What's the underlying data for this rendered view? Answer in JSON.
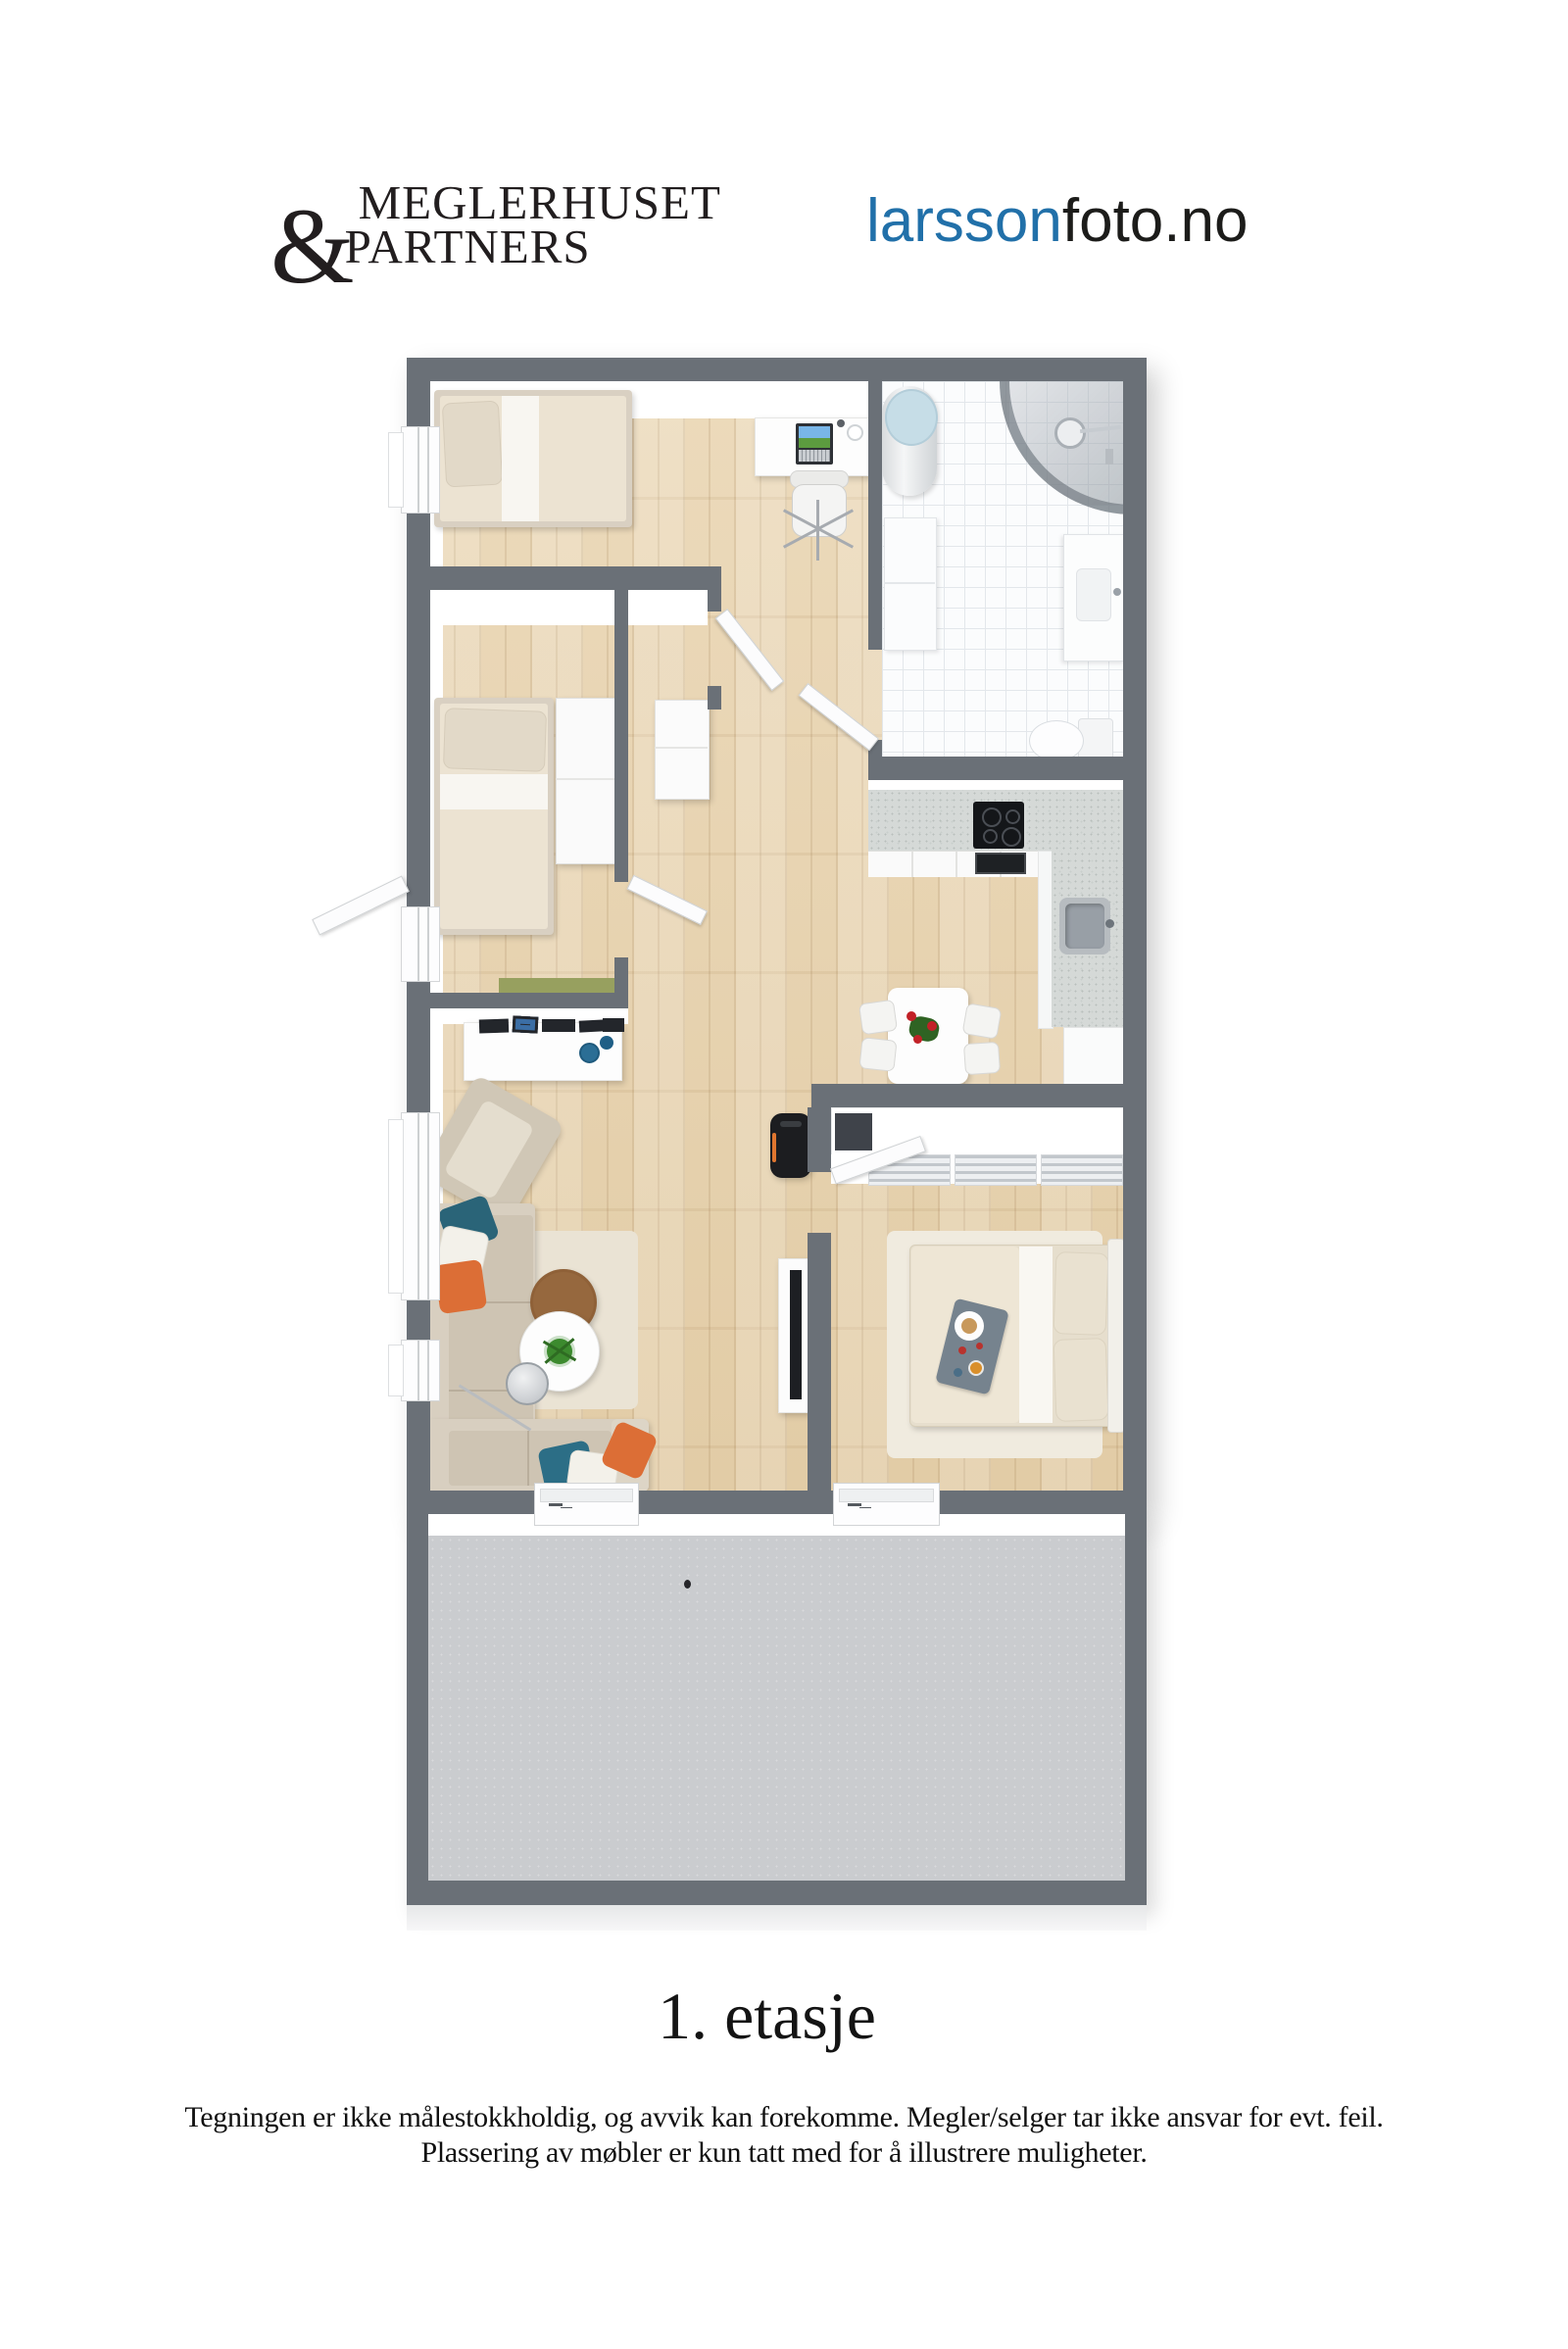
{
  "header": {
    "logo": {
      "ampersand": "&",
      "line1": "MEGLERHUSET",
      "line2": "PARTNERS",
      "color": "#221e1f"
    },
    "brand": {
      "name_part1": "larsson",
      "name_part2": "foto.no"
    }
  },
  "floorplan": {
    "floor_label": "1. etasje",
    "colors": {
      "wall": "#6a7077",
      "wood": "#e7d4b2",
      "tile": "#fbfcfd",
      "terrace": "#cacccf",
      "counter": "#d5d9d7",
      "sofa": "#d8cfc0",
      "pillow_teal": "#2a6478",
      "pillow_orange": "#dc6e36",
      "bench_green": "#97a05f",
      "stove_black": "#1c1d20",
      "flower_red": "#c22127",
      "accent_blue": "#2170a9"
    }
  },
  "footer": {
    "disclaimer_line1": "Tegningen er ikke målestokkholdig, og avvik kan forekomme. Megler/selger tar ikke ansvar for evt. feil.",
    "disclaimer_line2": "Plassering av møbler er kun tatt med for å illustrere muligheter."
  }
}
